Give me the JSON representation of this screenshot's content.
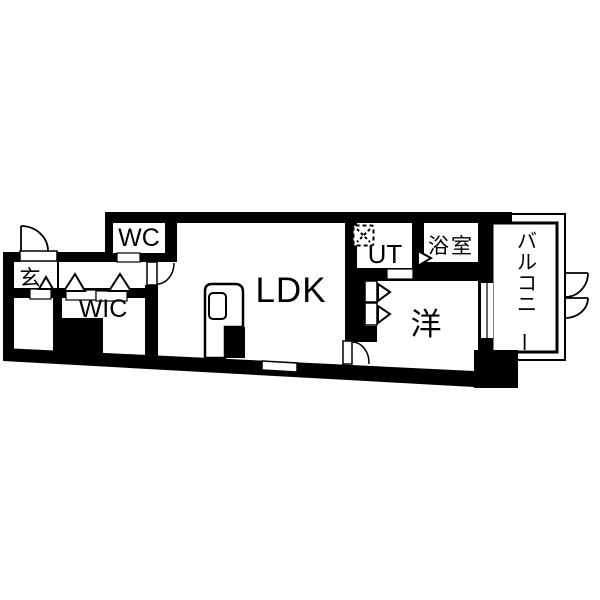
{
  "floorplan": {
    "colors": {
      "wall": "#000000",
      "floor": "#ffffff",
      "background": "#ffffff"
    },
    "rooms": {
      "entrance": {
        "label": "玄"
      },
      "wc": {
        "label": "WC"
      },
      "wic": {
        "label": "WIC"
      },
      "ldk": {
        "label": "LDK"
      },
      "ut": {
        "label": "UT"
      },
      "bathroom": {
        "label": "浴室"
      },
      "western_room": {
        "label": "洋"
      },
      "balcony": {
        "label": "バルコニー"
      }
    },
    "icons": {
      "washing_machine": "dashed-square-with-x",
      "door_swing": "quarter-arc",
      "sliding_door": "white-rect-track-marker",
      "closet_door": "triangle-marker",
      "window": "white-gap-in-wall"
    }
  }
}
